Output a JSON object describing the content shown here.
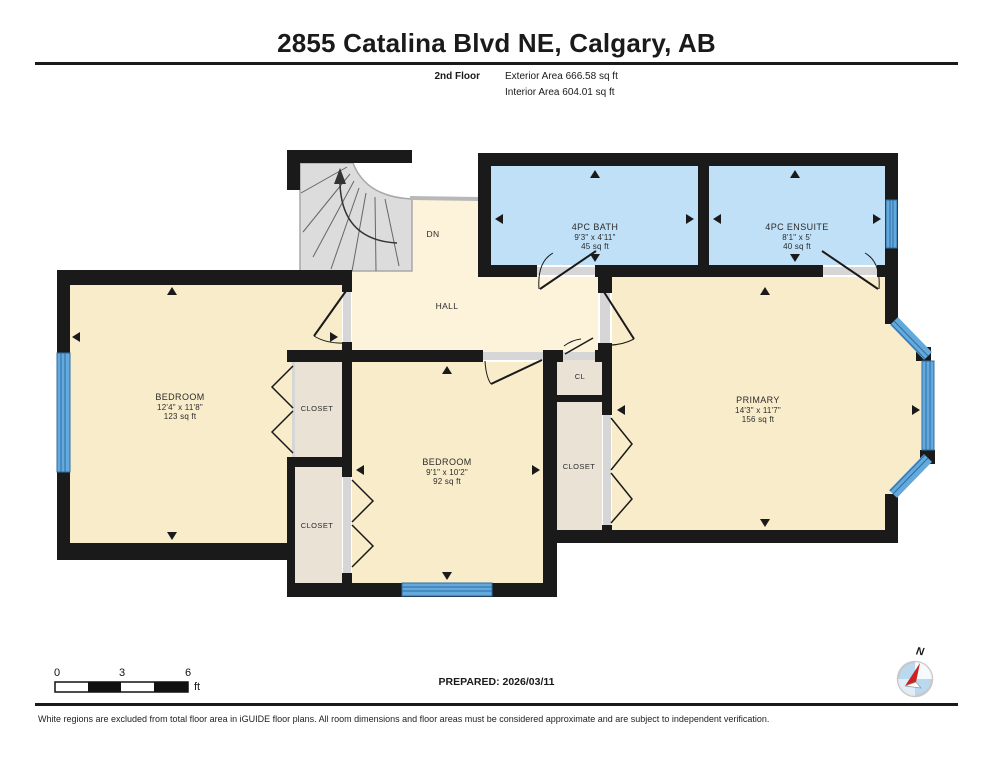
{
  "header": {
    "title": "2855 Catalina Blvd NE, Calgary, AB",
    "floor_label": "2nd Floor",
    "exterior_area": "Exterior Area 666.58 sq ft",
    "interior_area": "Interior Area 604.01 sq ft"
  },
  "rooms": {
    "bath": {
      "name": "4PC BATH",
      "dims": "9'3\" x 4'11\"",
      "area": "45 sq ft"
    },
    "ensuite": {
      "name": "4PC ENSUITE",
      "dims": "8'1\" x 5'",
      "area": "40 sq ft"
    },
    "bedroom_left": {
      "name": "BEDROOM",
      "dims": "12'4\" x 11'8\"",
      "area": "123 sq ft"
    },
    "bedroom_mid": {
      "name": "BEDROOM",
      "dims": "9'1\" x 10'2\"",
      "area": "92 sq ft"
    },
    "primary": {
      "name": "PRIMARY",
      "dims": "14'3\" x 11'7\"",
      "area": "156 sq ft"
    },
    "hall": {
      "name": "HALL"
    },
    "stairs": {
      "direction_label": "DN"
    },
    "closet_bedroom_left": {
      "name": "CLOSET"
    },
    "closet_bedroom_mid": {
      "name": "CLOSET"
    },
    "closet_primary": {
      "name": "CLOSET"
    },
    "closet_small": {
      "name": "CL"
    }
  },
  "scale_bar": {
    "tick_0": "0",
    "tick_3": "3",
    "tick_6": "6",
    "unit": "ft"
  },
  "compass": {
    "north_label": "N"
  },
  "footer": {
    "prepared": "PREPARED: 2026/03/11",
    "disclaimer": "White regions are excluded from total floor area in iGUIDE floor plans. All room dimensions and floor areas must be considered approximate and are subject to independent verification."
  },
  "colors": {
    "wall": "#1a1a1a",
    "room_fill": "#f9ecca",
    "hall_fill": "#fcf3da",
    "closet_fill": "#e9e2d5",
    "bath_fill": "#bfe0f6",
    "window_band": "#63a9dc",
    "window_stripe": "#2e6da4",
    "stairs_fill": "#dcdcdc",
    "threshold": "#d6d6d6",
    "compass_needle_red": "#cc2222",
    "compass_blue": "#b8d9f0"
  }
}
